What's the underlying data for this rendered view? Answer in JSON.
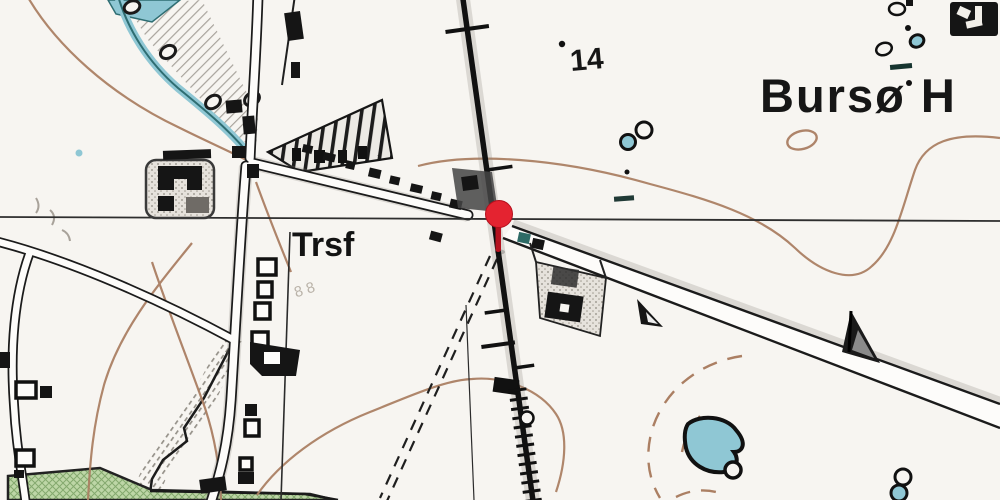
{
  "map": {
    "labels": {
      "place": "Bursø H",
      "elevation_point": "14",
      "transformer_station": "Trsf",
      "faint_plot_numbers": "8 8"
    },
    "marker": {
      "kind": "location-pin",
      "x": 500,
      "y": 215
    },
    "colors": {
      "paper": "#f7f5f1",
      "ink": "#161616",
      "contour_brown": "#ab7f63",
      "water_fill": "#8fc7d4",
      "water_dark": "#2e6d72",
      "vegetation_green": "#bdd6a6",
      "pin_red": "#e42330",
      "grid_line": "#2e2e2e"
    }
  }
}
